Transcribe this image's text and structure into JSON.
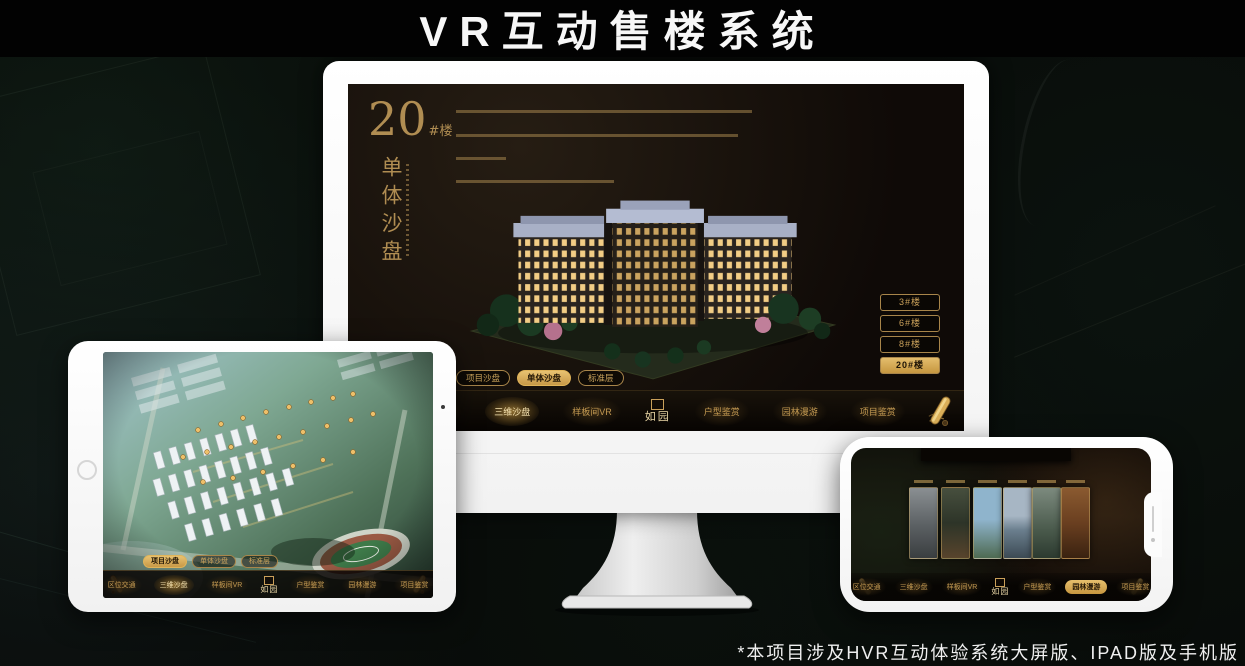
{
  "page": {
    "title": "VR互动售楼系统",
    "footnote": "*本项目涉及HVR互动体验系统大屏版、IPAD版及手机版"
  },
  "colors": {
    "accent_gold": "#c9a05a",
    "accent_gold_bright": "#e2b964",
    "screen_dark": "#140e09",
    "device_white": "#fbfbfb"
  },
  "nav_menu": {
    "logo": "如园",
    "items": [
      "区位交通",
      "三维沙盘",
      "样板间VR",
      "户型鉴赏",
      "园林漫游",
      "项目鉴赏"
    ]
  },
  "sub_tabs": [
    "项目沙盘",
    "单体沙盘",
    "标准层"
  ],
  "monitor": {
    "building_number": "20",
    "building_number_suffix": "#楼",
    "section_title_vertical": "单体沙盘",
    "floor_buttons": [
      "3#楼",
      "6#楼",
      "8#楼",
      "20#楼"
    ],
    "active_floor": "20#楼",
    "active_sub_tab": "单体沙盘",
    "active_nav": "三维沙盘"
  },
  "ipad": {
    "active_sub_tab": "项目沙盘",
    "active_nav": "三维沙盘"
  },
  "phone": {
    "active_nav": "园林漫游"
  }
}
